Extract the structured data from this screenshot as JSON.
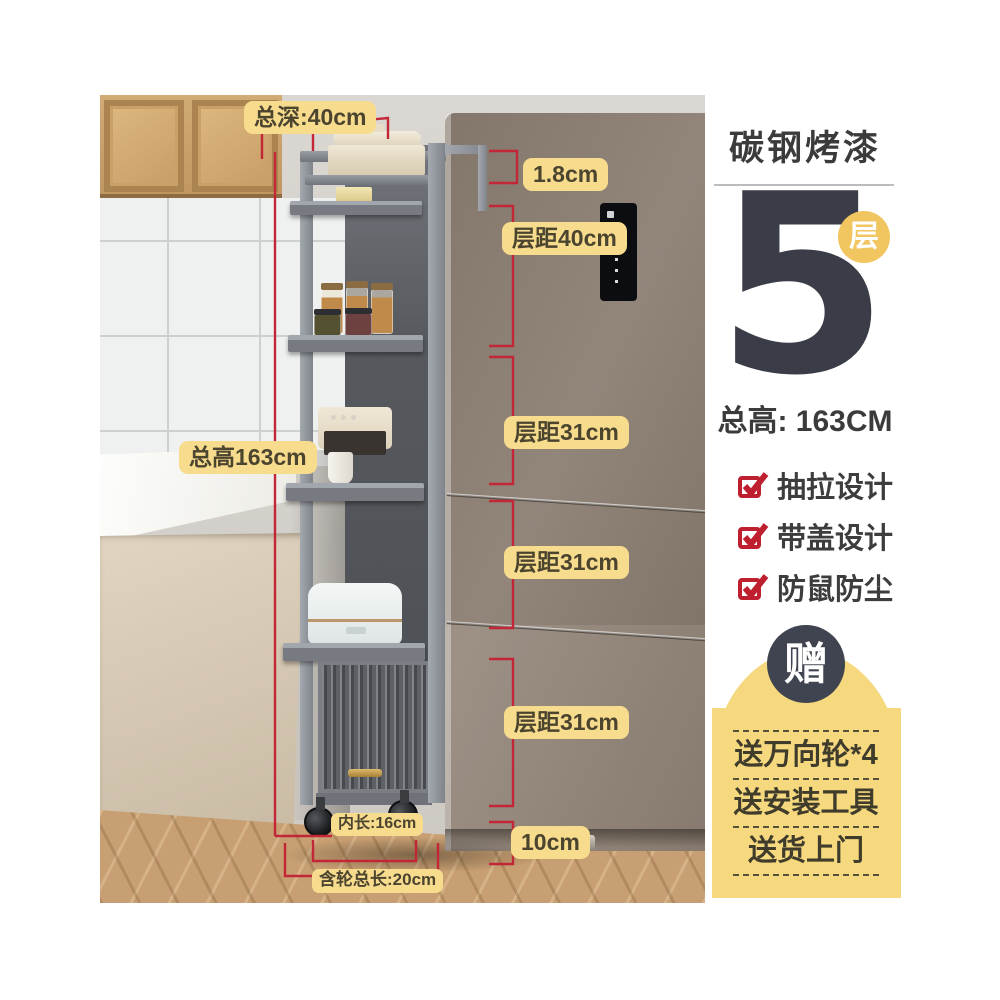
{
  "product_card": {
    "material_title": "碳钢烤漆",
    "tier_count": "5",
    "tier_unit_badge": "层",
    "total_height_text": "总高: 163CM",
    "features": [
      {
        "label": "抽拉设计"
      },
      {
        "label": "带盖设计"
      },
      {
        "label": "防鼠防尘"
      }
    ],
    "gift_badge": "赠",
    "gift_items": [
      {
        "label": "送万向轮*4"
      },
      {
        "label": "送安装工具"
      },
      {
        "label": "送货上门"
      }
    ]
  },
  "measurements": {
    "total_depth": "总深:40cm",
    "total_height": "总高163cm",
    "top_gap": "1.8cm",
    "tier_gap_1": "层距40cm",
    "tier_gap_2": "层距31cm",
    "tier_gap_3": "层距31cm",
    "tier_gap_4": "层距31cm",
    "bottom_clearance": "10cm",
    "inner_length": "内长:16cm",
    "length_with_wheels": "含轮总长:20cm"
  },
  "colors": {
    "annotation_label_bg": "#f8dc8d",
    "annotation_line_red": "#c32636",
    "feature_check_red": "#bf202f",
    "tier_badge_yellow": "#f1c55f",
    "gift_panel_yellow": "#f6d87e",
    "gift_badge_dark": "#3f4450",
    "headline_dark": "#3a3d47"
  }
}
